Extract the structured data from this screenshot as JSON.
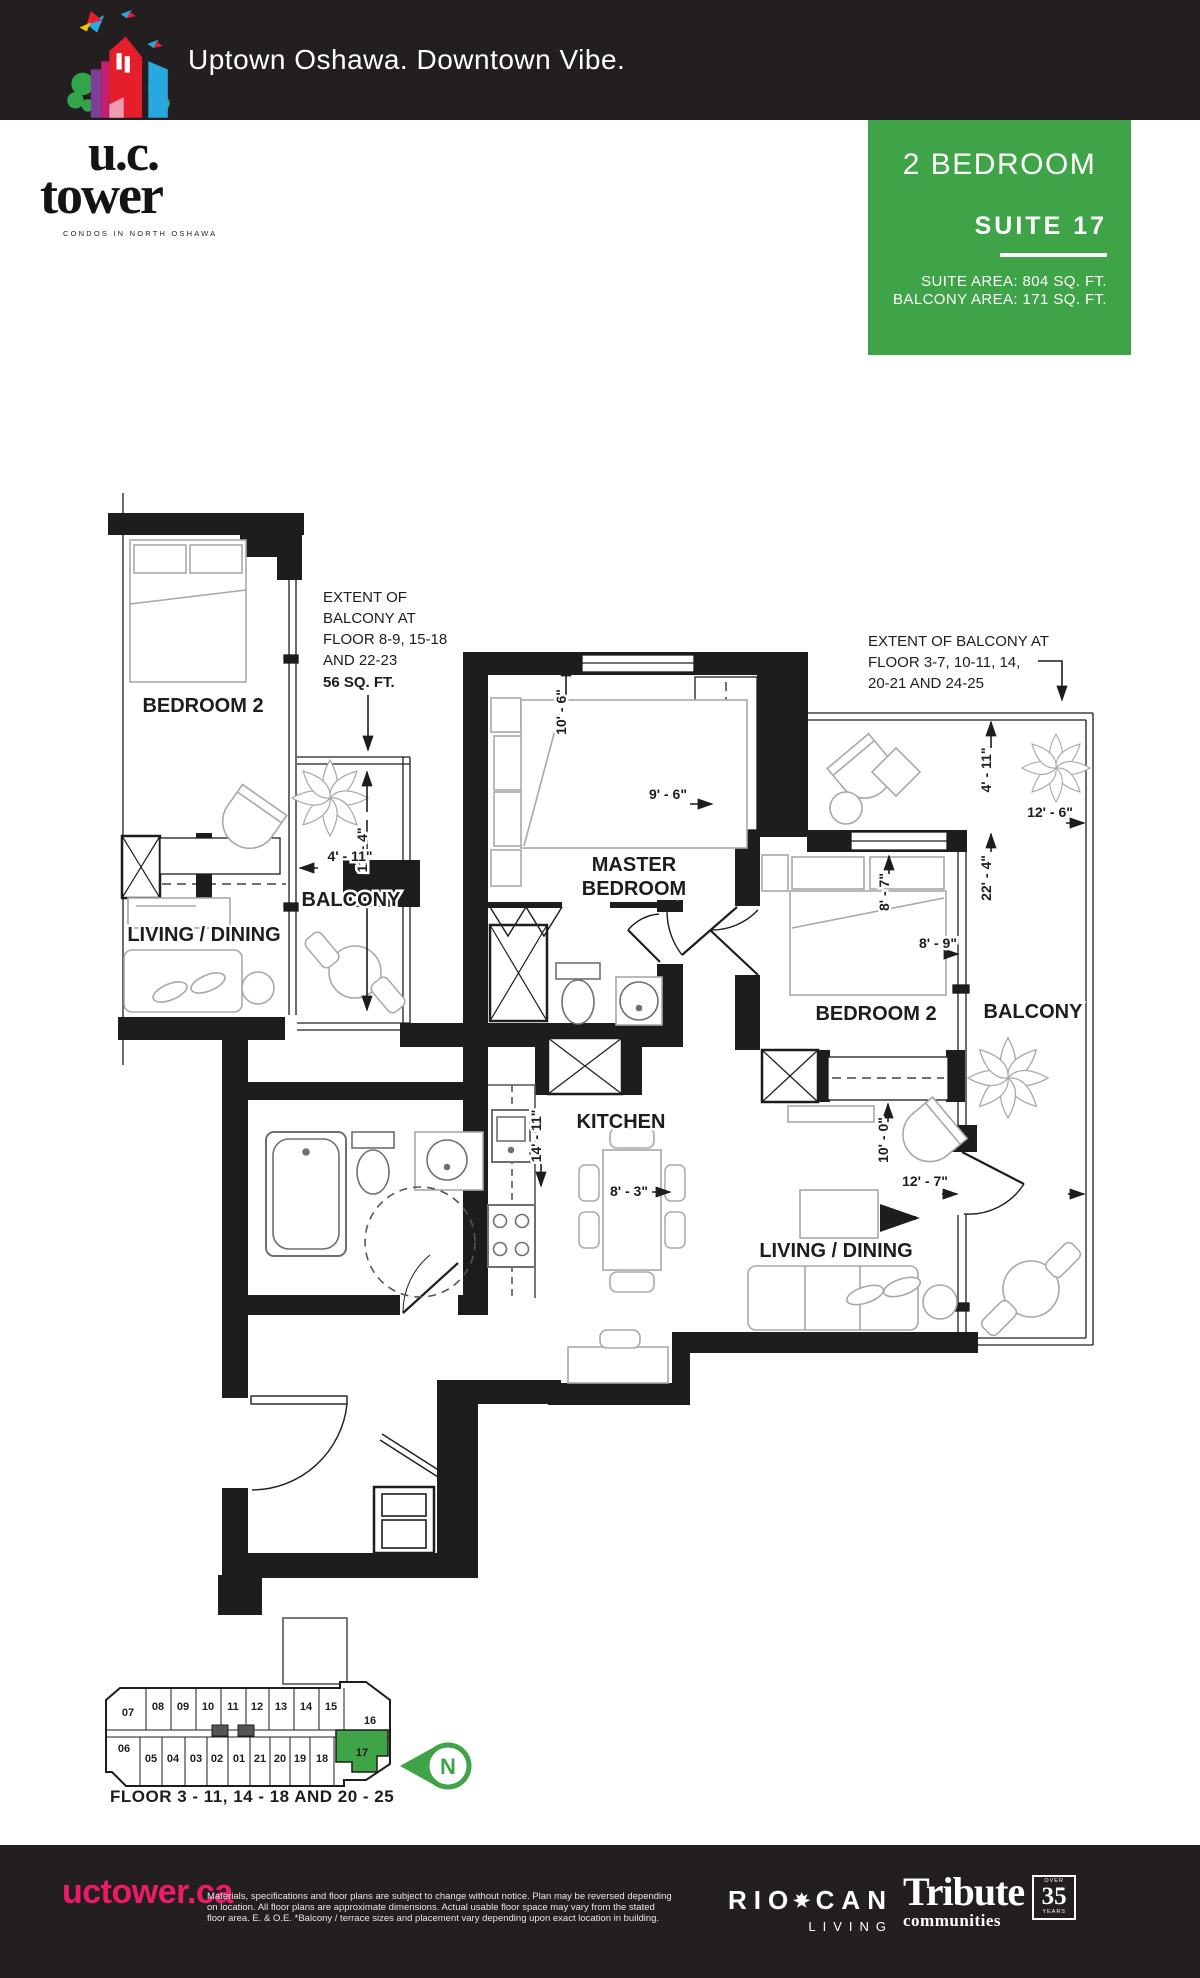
{
  "header": {
    "tagline": "Uptown Oshawa. Downtown Vibe."
  },
  "logo": {
    "name_top": "u.c.",
    "name_bottom": "tower",
    "subtitle": "CONDOS IN NORTH OSHAWA",
    "icon": "uc-tower-colorful-building-with-birds"
  },
  "suite_info": {
    "type": "2 BEDROOM",
    "suite": "SUITE 17",
    "area_line1": "SUITE AREA: 804 SQ. FT.",
    "area_line2": "BALCONY AREA: 171 SQ. FT."
  },
  "colors": {
    "accent_green": "#3fa347",
    "brand_pink": "#ed1a68",
    "bar_black": "#231f20"
  },
  "plan": {
    "rooms": {
      "bedroom2_left": "BEDROOM 2",
      "living_left": "LIVING / DINING",
      "balcony_left": "BALCONY",
      "master_1": "MASTER",
      "master_2": "BEDROOM",
      "bedroom2_right": "BEDROOM 2",
      "balcony_right": "BALCONY",
      "kitchen": "KITCHEN",
      "living_right": "LIVING / DINING"
    },
    "dims": {
      "master_width": "10' - 6\"",
      "master_depth": "9' - 6\"",
      "left_balcony_length": "11' - 4\"",
      "left_balcony_width": "4' - 11\"",
      "right_balcony_depth": "4' - 11\"",
      "right_balcony_width": "12' - 6\"",
      "right_side_length": "22' - 4\"",
      "bedroom2_width": "8' - 7\"",
      "bedroom2_depth": "8' - 9\"",
      "living_width": "10' - 0\"",
      "living_balcony_width": "12' - 7\"",
      "kitchen_length": "14' - 11\"",
      "dining_width": "8' - 3\""
    },
    "annotations": {
      "left_lines": [
        "EXTENT OF",
        "BALCONY AT",
        "FLOOR 8-9, 15-18",
        "AND 22-23"
      ],
      "left_area": "56 SQ. FT.",
      "right_lines": [
        "EXTENT OF BALCONY AT",
        "FLOOR 3-7, 10-11, 14,",
        "20-21 AND 24-25"
      ]
    }
  },
  "keyplan": {
    "top": [
      "07",
      "08",
      "09",
      "10",
      "11",
      "12",
      "13",
      "14",
      "15",
      "16"
    ],
    "bottom": [
      "06",
      "05",
      "04",
      "03",
      "02",
      "01",
      "21",
      "20",
      "19",
      "18",
      "17"
    ],
    "highlighted_suite": "17",
    "compass": "N",
    "floor_note": "FLOOR 3 - 11, 14 - 18 AND 20 - 25"
  },
  "footer": {
    "website": "uctower.ca",
    "disclaimer_lines": [
      "Materials, specifications and floor plans are subject to change without notice. Plan may be reversed depending",
      "on location. All floor plans are approximate dimensions. Actual usable floor space may vary from the stated",
      "floor area.  E. & O.E.  *Balcony / terrace sizes and placement vary depending upon exact location in building."
    ],
    "riocan": {
      "word1": "RIO",
      "word2": "CAN",
      "sub": "LIVING"
    },
    "tribute": {
      "name": "Tribute",
      "sub": "communities",
      "badge_top": "OVER",
      "badge_num": "35",
      "badge_bottom": "YEARS"
    }
  }
}
